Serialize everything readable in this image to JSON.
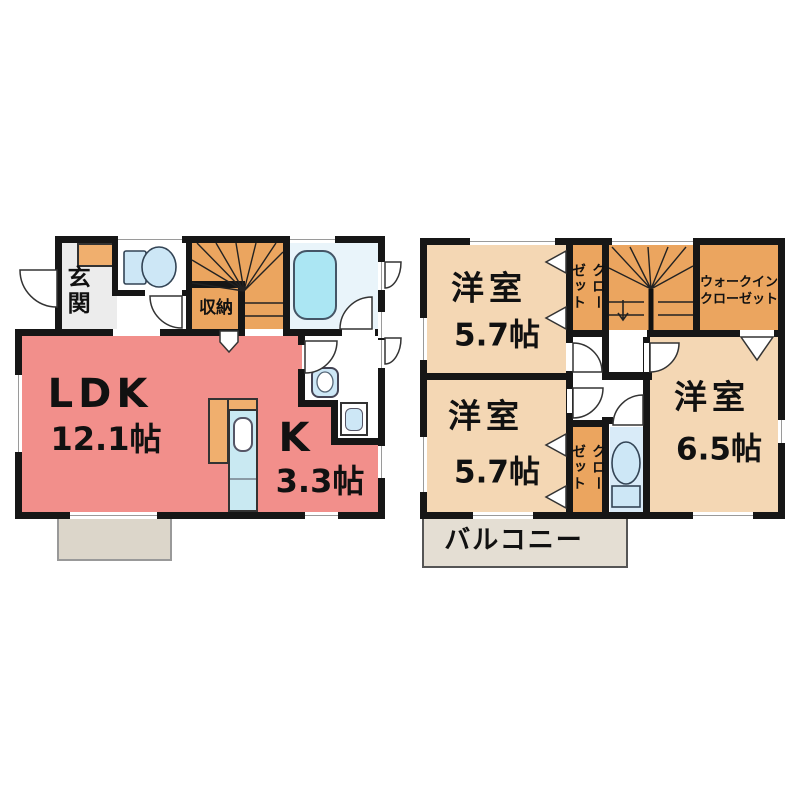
{
  "colors": {
    "wall": "#161616",
    "outline": "#333333",
    "ldk": "#F28F8B",
    "room": "#F4D7B4",
    "stairs": "#EBA55F",
    "cabinet": "#F0AF6E",
    "bath_floor": "#E9F4FA",
    "tub": "#ABE6F3",
    "toilet_floor": "#D9EBF8",
    "fixture": "#CDE7F6",
    "counter": "#C9E9F2",
    "porch": "#DCD6CA",
    "balcony": "#E4DED3"
  },
  "floor1": {
    "entrance_label": "玄関",
    "storage_label": "収納",
    "ldk_label": "LDK",
    "ldk_size": "12.1帖",
    "kitchen_label": "K",
    "kitchen_size": "3.3帖"
  },
  "floor2": {
    "room1_label": "洋室",
    "room1_size": "5.7帖",
    "closet1_col1": "クロー",
    "closet1_col2": "ゼット",
    "wic_line1": "ウォークイン",
    "wic_line2": "クローゼット",
    "room2_label": "洋室",
    "room2_size": "5.7帖",
    "closet2_col1": "クロー",
    "closet2_col2": "ゼット",
    "room3_label": "洋室",
    "room3_size": "6.5帖",
    "balcony_label": "バルコニー"
  }
}
